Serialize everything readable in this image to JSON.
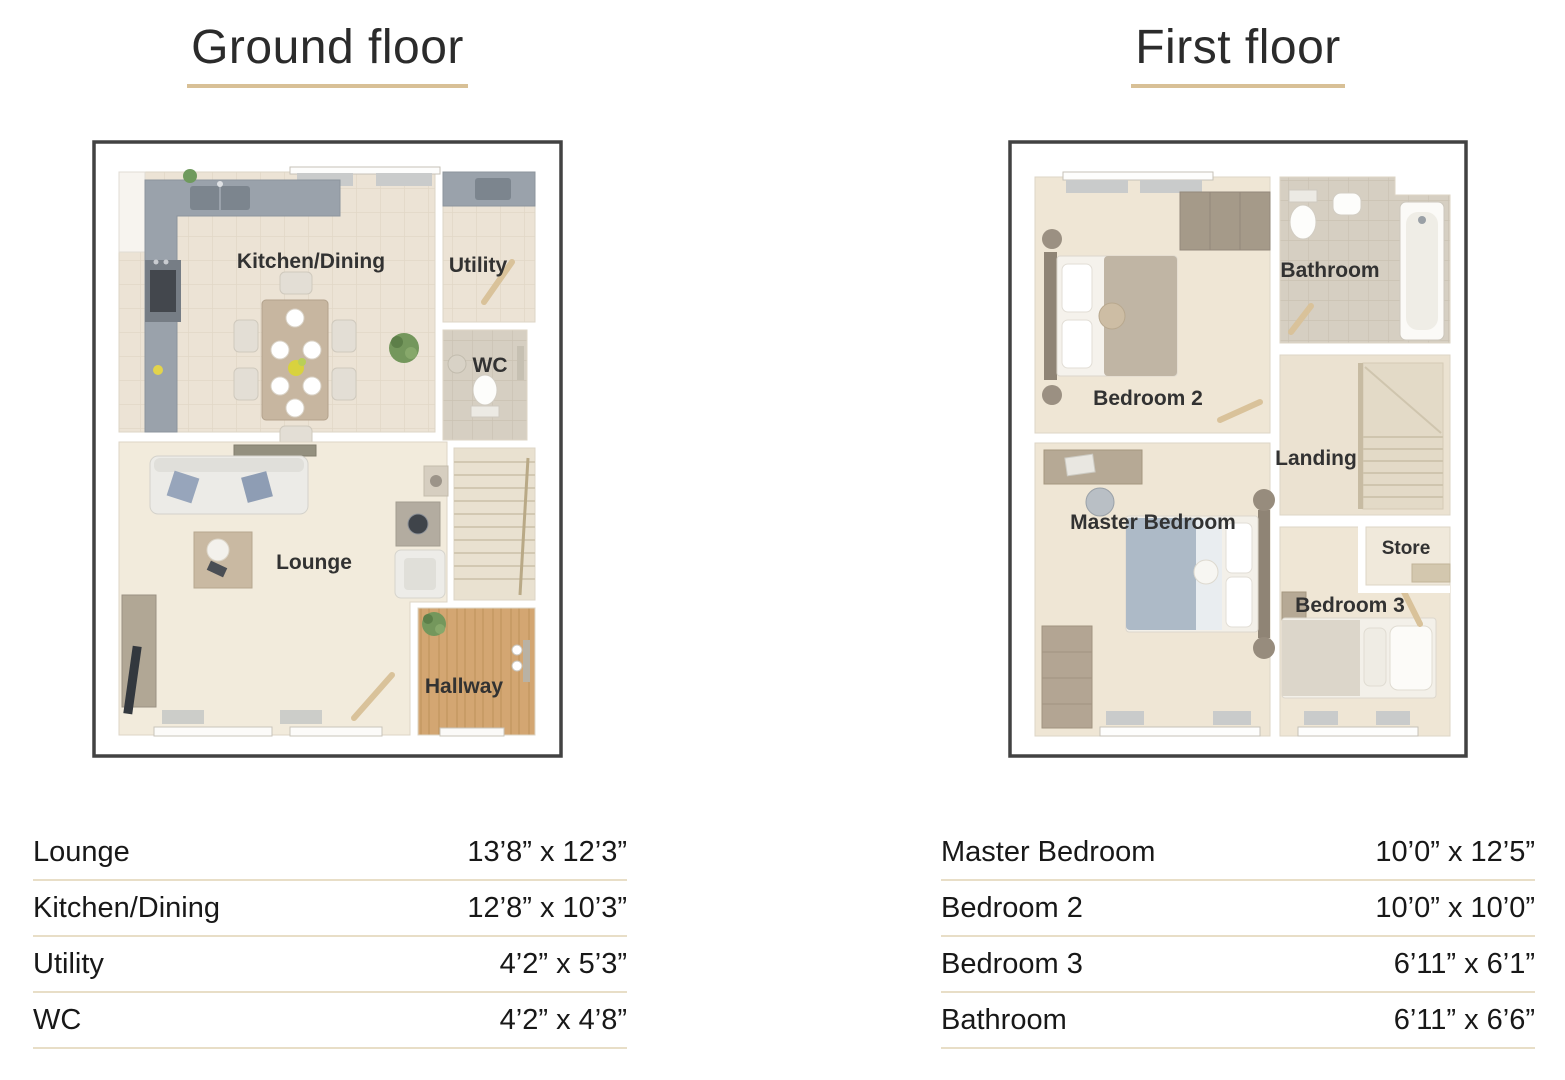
{
  "colors": {
    "title_underline": "#d8c096",
    "table_rule": "#e8dec7",
    "plan_border": "#424242",
    "carpet_floor": "#efe6d5",
    "tile_floor_beige": "#ece3d5",
    "tile_floor_grey": "#d6cfc2",
    "wood_floor": "#d3a672",
    "counter_grey": "#9aa2ab"
  },
  "floors": [
    {
      "title": "Ground floor",
      "plan": {
        "labels": {
          "kitchen_dining": "Kitchen/Dining",
          "utility": "Utility",
          "wc": "WC",
          "lounge": "Lounge",
          "hallway": "Hallway"
        }
      },
      "rooms": [
        {
          "name": "Lounge",
          "size": "13’8” x 12’3”"
        },
        {
          "name": "Kitchen/Dining",
          "size": "12’8” x 10’3”"
        },
        {
          "name": "Utility",
          "size": "4’2” x 5’3”"
        },
        {
          "name": "WC",
          "size": "4’2” x 4’8”"
        }
      ]
    },
    {
      "title": "First floor",
      "plan": {
        "labels": {
          "bedroom2": "Bedroom 2",
          "bathroom": "Bathroom",
          "landing": "Landing",
          "master_bedroom": "Master Bedroom",
          "store": "Store",
          "bedroom3": "Bedroom 3"
        }
      },
      "rooms": [
        {
          "name": "Master Bedroom",
          "size": "10’0” x 12’5”"
        },
        {
          "name": "Bedroom 2",
          "size": "10’0” x 10’0”"
        },
        {
          "name": "Bedroom 3",
          "size": "6’11” x 6’1”"
        },
        {
          "name": "Bathroom",
          "size": "6’11” x 6’6”"
        }
      ]
    }
  ]
}
